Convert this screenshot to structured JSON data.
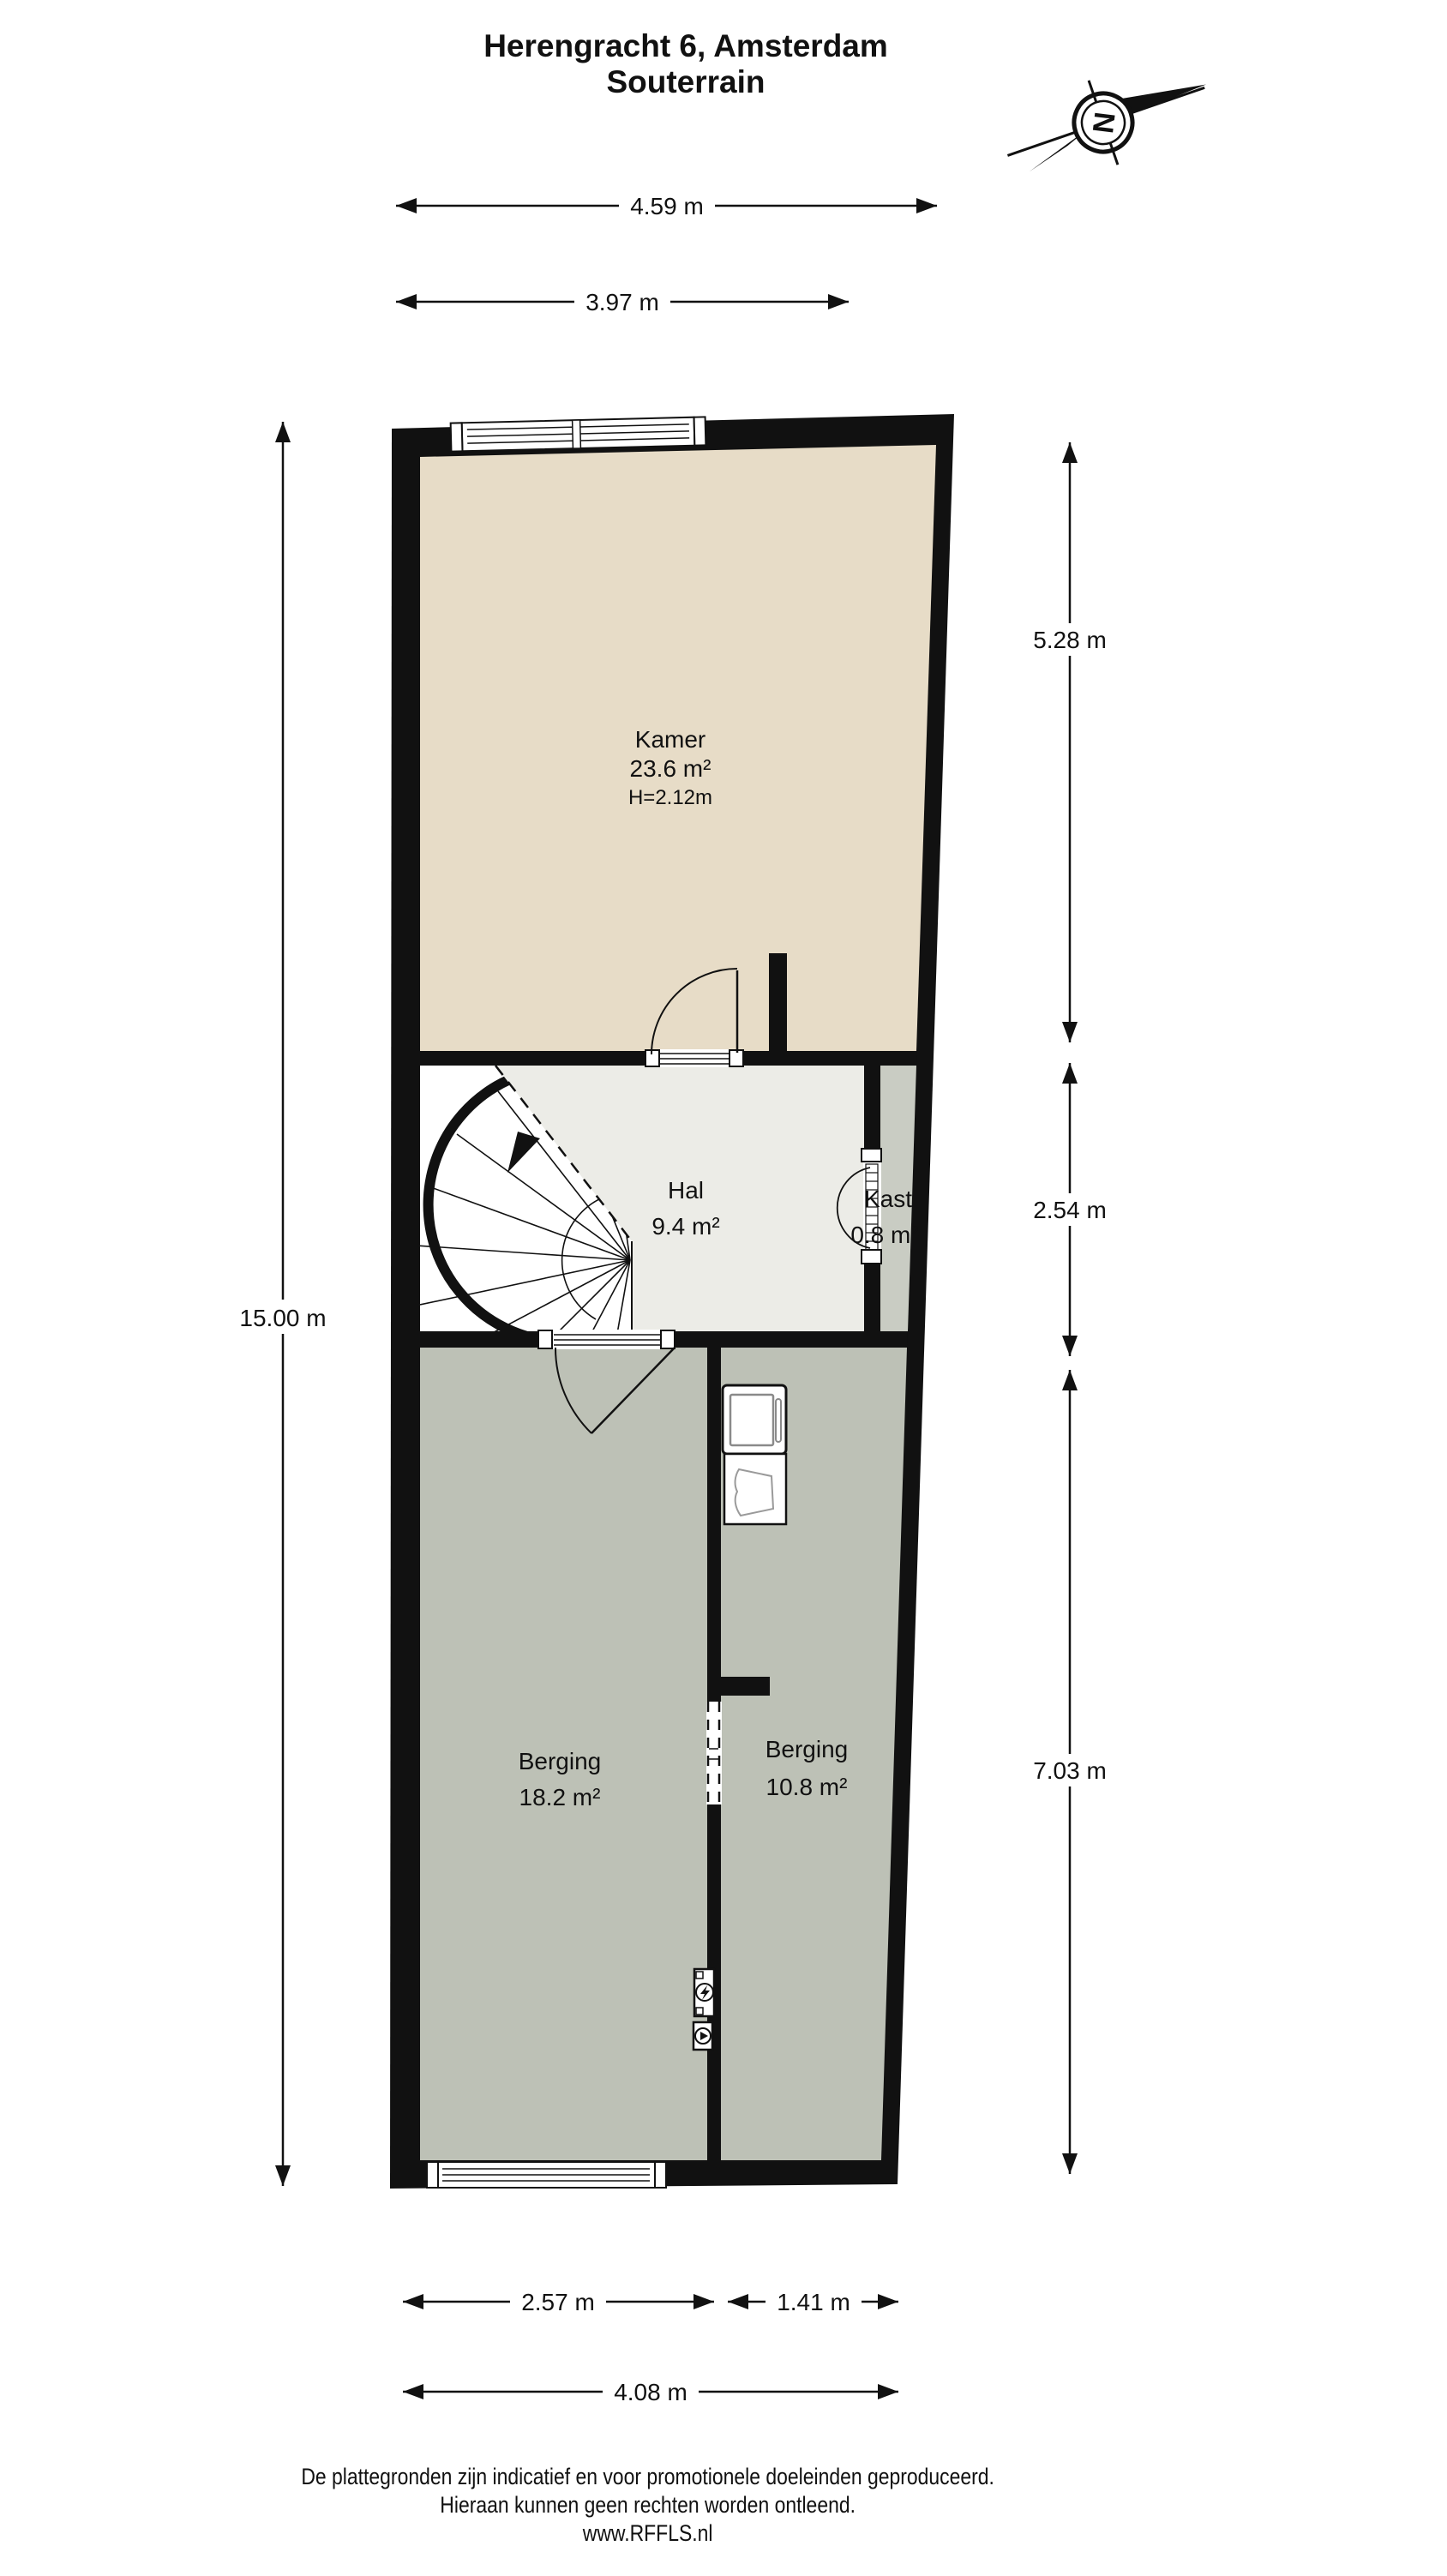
{
  "title": {
    "line1": "Herengracht 6, Amsterdam",
    "line2": "Souterrain"
  },
  "compass": {
    "north_letter": "N"
  },
  "rooms": {
    "kamer": {
      "name": "Kamer",
      "area": "23.6 m²",
      "ceiling_height": "H=2.12m"
    },
    "hal": {
      "name": "Hal",
      "area": "9.4 m²"
    },
    "kast": {
      "name": "Kast",
      "area": "0.8 m²"
    },
    "berging_links": {
      "name": "Berging",
      "area": "18.2 m²"
    },
    "berging_rechts": {
      "name": "Berging",
      "area": "10.8 m²"
    }
  },
  "dimensions": {
    "top_total": "4.59 m",
    "top_front": "3.97 m",
    "left_total": "15.00 m",
    "right_kamer": "5.28 m",
    "right_hal": "2.54 m",
    "right_berging": "7.03 m",
    "bottom_left": "2.57 m",
    "bottom_right": "1.41 m",
    "bottom_total": "4.08 m"
  },
  "footer": {
    "line1": "De plattegronden zijn indicatief en voor promotionele doeleinden geproduceerd.",
    "line2": "Hieraan kunnen geen rechten worden ontleend.",
    "line3": "www.RFFLS.nl"
  },
  "colors": {
    "wall": "#111111",
    "kamer_floor": "#e7dcc7",
    "hal_floor": "#ececе7",
    "hal_floor_fix": "#ecece7",
    "kast_floor": "#c9ccc3",
    "berging_floor": "#bdc1b6",
    "background": "#ffffff"
  }
}
